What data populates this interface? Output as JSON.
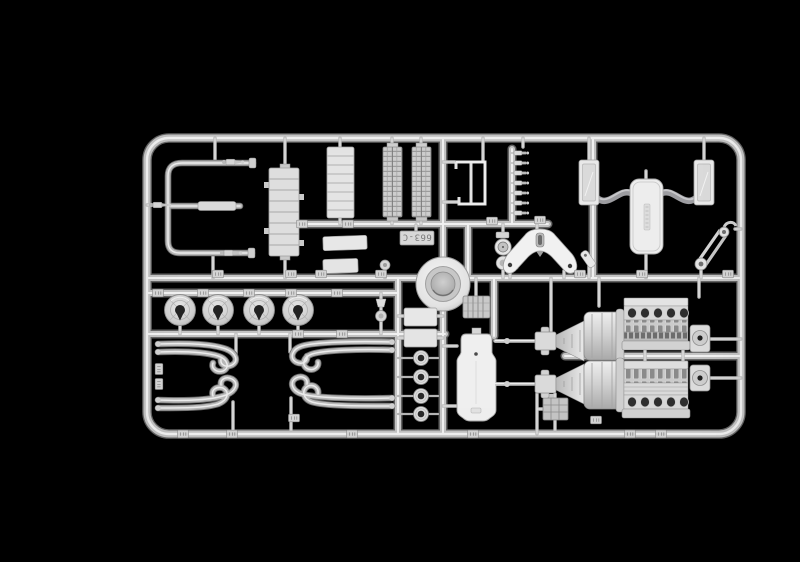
{
  "scene": {
    "description": "Product photograph of a light-gray injection-molded model-kit sprue (parts frame) on a plain black background",
    "background_color": "#000000",
    "plastic_light": "#ececec",
    "plastic_mid": "#c3c3c3",
    "plastic_shadow": "#6d6d6d",
    "hose_gray": "#9c9ca0",
    "hole_dark": "#1f1f1f"
  },
  "sprue": {
    "tag_label": "663-C",
    "counts": {
      "brake_discs": 4,
      "hub_rings": 4,
      "exhaust_pipe_sets": 4,
      "injectors": 7,
      "engine_block_halves": 2,
      "gearboxes": 2,
      "side_panels": 2,
      "grille_towers": 2,
      "small_plates": 4,
      "part_number_tags": 28
    },
    "parts": [
      "roll-bar-tube",
      "nozzle-fitting",
      "radiator-core",
      "ribbed-panel",
      "grille-tower",
      "cage-frame",
      "injector-rail",
      "gauge-pump",
      "axle-bracket",
      "angled-fitting",
      "side-panel",
      "fuel-tank",
      "connecting-hose",
      "belt-tensioner",
      "brake-drum",
      "small-plate",
      "mirror-stem",
      "brake-disc",
      "exhaust-pipe-set",
      "hub-ring",
      "oil-cooler",
      "floor-pan",
      "battery-box",
      "engine-block-half",
      "gearbox",
      "end-cap"
    ]
  }
}
